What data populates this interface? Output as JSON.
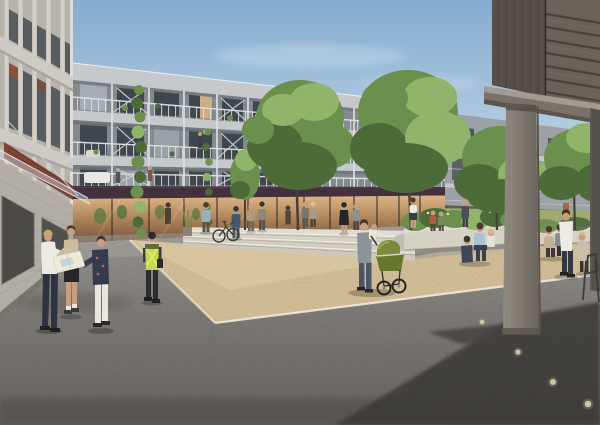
{
  "meta": {
    "title": "Architectural rendering — residential courtyard plaza",
    "description": "Sunlit visualization of a housing block courtyard: a four-storey grey timber apartment building with continuous steel balconies and ground-floor shops wraps a beige gravel plaza with wide concrete steps and a planted seating terrace. People study site plans, push a green pram, cycle and sit in the sun; a dark timber volume on concrete pillars frames the view at right."
  },
  "palette": {
    "sky-top": "#85abd0",
    "sky-mid": "#b7cfe2",
    "sky-horizon": "#e6eef3",
    "cloud": "#ffffff",
    "facade": "#848b91",
    "slab": "#c6c9cb",
    "slab-shadow": "#70767c",
    "post-steel": "#dcdee0",
    "window": "#3f474e",
    "window-lit": "#ddb88a",
    "fascia-plum": "#44303c",
    "left-light": "#d4d0c9",
    "left-mid": "#b9b4ab",
    "left-window": "#565c60",
    "awning-red": "#7c4336",
    "terrace": "#b4b0a8",
    "lawn": "#9fab6d",
    "tree-dark": "#4d6b39",
    "tree-mid": "#6b8f4c",
    "tree-light": "#8fb46a",
    "trunk": "#4a4038",
    "gravel": "#d9c49c",
    "gravel-light": "#e4d2ac",
    "curb": "#efeadd",
    "asphalt-light": "#a09d99",
    "asphalt-mid": "#827f7b",
    "asphalt-dark": "#4f4c49",
    "shadow": "#3e3b39",
    "concrete-step": "#e0dcd2",
    "step-face": "#d6d1c5",
    "pillar-light": "#918a81",
    "pillar-dark": "#6b645c",
    "structure-dark": "#4f4843",
    "structure-slat": "#6b6259",
    "beam-top": "#a39a90",
    "beam-face": "#7a7269",
    "pram-green": "#7a8c3c",
    "pram-dark": "#66762f",
    "vest-yellow": "#c6d94e",
    "skin": "#c79e7f",
    "white-cloth": "#eceae3",
    "dark-cloth": "#2e3340",
    "denim": "#4a5668",
    "plan-paper": "#efe9d8"
  },
  "scene": {
    "setting": "residential courtyard plaza, daytime, clear sky",
    "buildings": [
      {
        "name": "courtyard apartment block",
        "floors": 4,
        "features": [
          "continuous steel balconies",
          "diagonal cross bracing",
          "climbing vines",
          "ground-floor shops with dark plum fascia",
          "warm lit shopfronts"
        ]
      },
      {
        "name": "left residential building",
        "features": [
          "light grey panels",
          "glass entrance canopy",
          "red-brown awning"
        ]
      },
      {
        "name": "background block",
        "features": [
          "balconies behind trees",
          "orange door accents"
        ]
      },
      {
        "name": "foreground timber volume",
        "features": [
          "dark horizontal slats",
          "concrete beam",
          "concrete pillars",
          "open passage beneath"
        ]
      }
    ],
    "plaza": {
      "surface": "beige bound gravel",
      "edge": "light concrete curb",
      "foreground": "dark asphalt with cast shadow and round pavement lights",
      "steps": 3,
      "planter": "raised concrete planter with shrubs and trees"
    },
    "people": [
      {
        "label": "three people studying site plans",
        "x": 70,
        "y": 285
      },
      {
        "label": "worker in hi-vis vest",
        "x": 152,
        "y": 270
      },
      {
        "label": "pedestrians along shopfronts",
        "x": 230,
        "y": 225
      },
      {
        "label": "woman in black dress",
        "x": 344,
        "y": 218
      },
      {
        "label": "man carrying baby beside green pram",
        "x": 380,
        "y": 260
      },
      {
        "label": "women and child seated at planter steps",
        "x": 478,
        "y": 245
      },
      {
        "label": "couple seated on concrete bench",
        "x": 554,
        "y": 243
      },
      {
        "label": "man walking with child",
        "x": 572,
        "y": 245
      },
      {
        "label": "residents on balconies",
        "x": 180,
        "y": 150
      }
    ],
    "objects": [
      "green baby pram",
      "parked bicycle",
      "metal cafe chair",
      "potted grasses",
      "climbing vines",
      "courtyard trees",
      "round pavement lights"
    ]
  }
}
